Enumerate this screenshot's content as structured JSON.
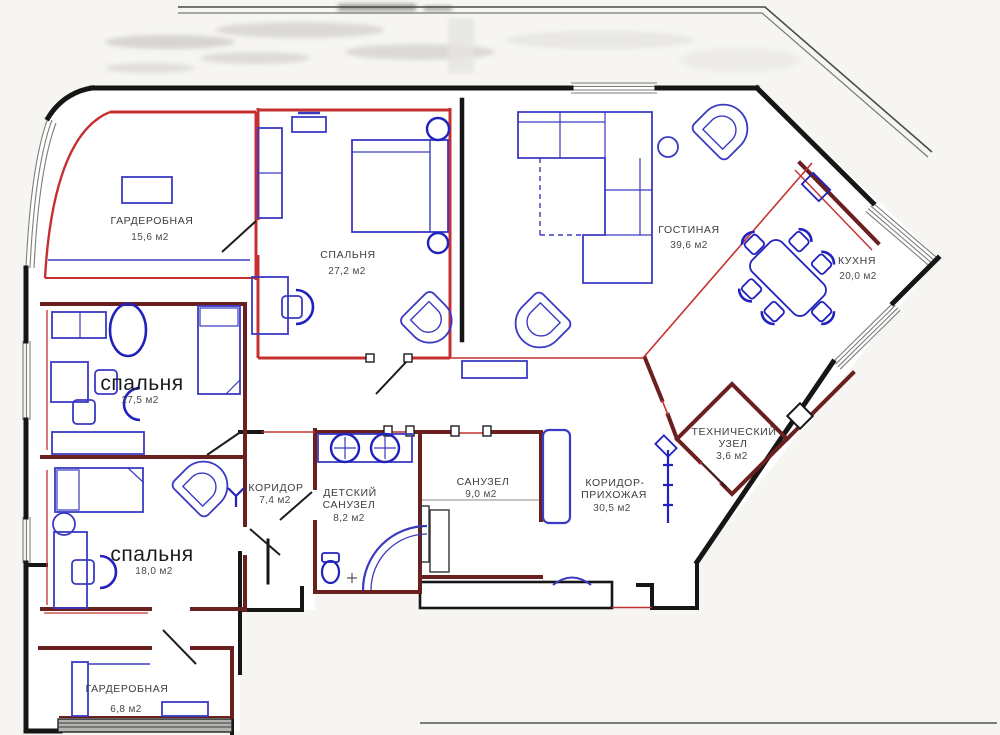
{
  "plan": {
    "colors": {
      "outer_wall": "#161616",
      "partition_wall": "#6b2020",
      "accent_red": "#c43030",
      "furniture_blue": "#3a3ac2",
      "furniture_deep_blue": "#2121bd",
      "window_gray": "#8a8a8a",
      "background": "#f6f5f2",
      "floor": "#ffffff"
    },
    "rooms": [
      {
        "id": "wardrobe-top",
        "lines": [
          "ГАРДЕРОБНАЯ"
        ],
        "area": "15,6 м2"
      },
      {
        "id": "bedroom-master",
        "lines": [
          "СПАЛЬНЯ"
        ],
        "area": "27,2 м2"
      },
      {
        "id": "living-room",
        "lines": [
          "ГОСТИНАЯ"
        ],
        "area": "39,6 м2"
      },
      {
        "id": "kitchen",
        "lines": [
          "КУХНЯ"
        ],
        "area": "20,0 м2"
      },
      {
        "id": "bedroom-left",
        "lines": [
          "спальня"
        ],
        "area": "17,5 м2"
      },
      {
        "id": "bedroom-lower",
        "lines": [
          "спальня"
        ],
        "area": "18,0 м2"
      },
      {
        "id": "corridor",
        "lines": [
          "КОРИДОР"
        ],
        "area": "7,4 м2"
      },
      {
        "id": "kids-bathroom",
        "lines": [
          "ДЕТСКИЙ",
          "САНУЗЕЛ"
        ],
        "area": "8,2 м2"
      },
      {
        "id": "bathroom",
        "lines": [
          "САНУЗЕЛ"
        ],
        "area": "9,0 м2"
      },
      {
        "id": "hallway",
        "lines": [
          "КОРИДОР-",
          "ПРИХОЖАЯ"
        ],
        "area": "30,5 м2"
      },
      {
        "id": "technical-unit",
        "lines": [
          "ТЕХНИЧЕСКИЙ",
          "УЗЕЛ"
        ],
        "area": "3,6 м2"
      },
      {
        "id": "wardrobe-bottom",
        "lines": [
          "ГАРДЕРОБНАЯ"
        ],
        "area": "6,8 м2"
      }
    ]
  }
}
